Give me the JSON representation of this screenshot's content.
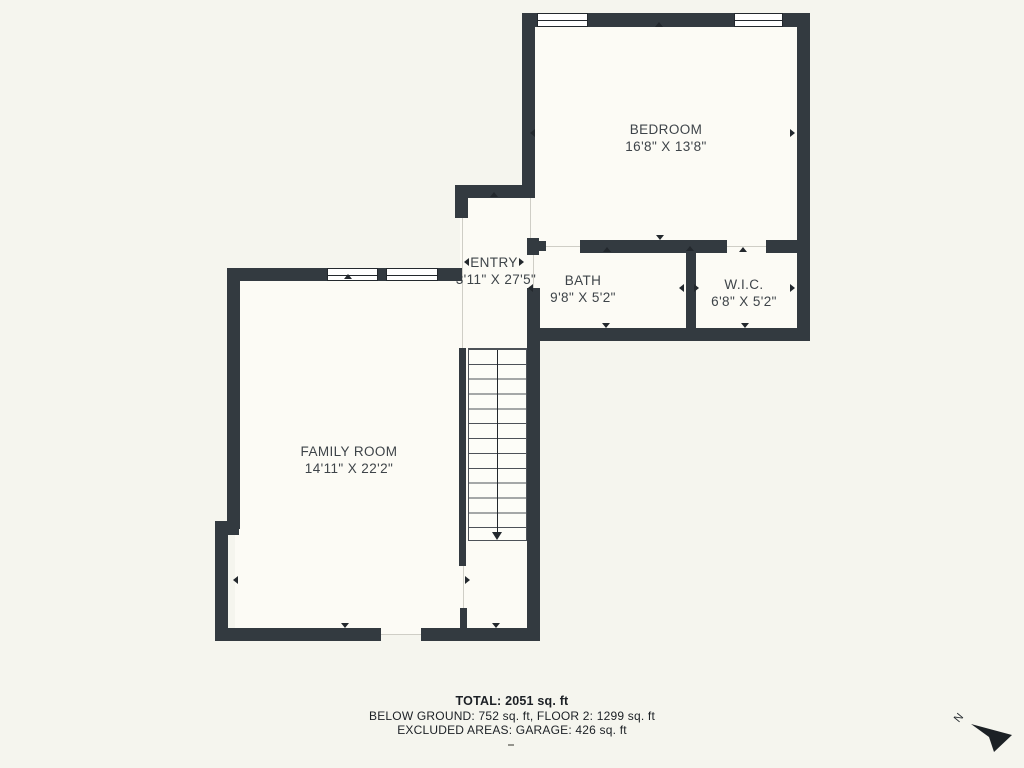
{
  "plan": {
    "rooms": [
      {
        "name": "BEDROOM",
        "dims": "16'8\" X 13'8\""
      },
      {
        "name": "ENTRY",
        "dims": "3'11\" X 27'5\""
      },
      {
        "name": "BATH",
        "dims": "9'8\" X 5'2\""
      },
      {
        "name": "W.I.C.",
        "dims": "6'8\" X 5'2\""
      },
      {
        "name": "FAMILY ROOM",
        "dims": "14'11\" X 22'2\""
      }
    ],
    "features": [
      "staircase",
      "windows",
      "door-openings"
    ]
  },
  "summary": {
    "total": "TOTAL: 2051 sq. ft",
    "breakdown": "BELOW GROUND: 752 sq. ft, FLOOR 2: 1299 sq. ft",
    "excluded": "EXCLUDED AREAS: GARAGE: 426 sq. ft"
  },
  "compass": {
    "label": "N"
  },
  "colors": {
    "wall": "#333a40",
    "background": "#f5f5ee",
    "floor": "#fcfbf5",
    "label_text": "#3e4449",
    "summary_text": "#1c2025"
  }
}
